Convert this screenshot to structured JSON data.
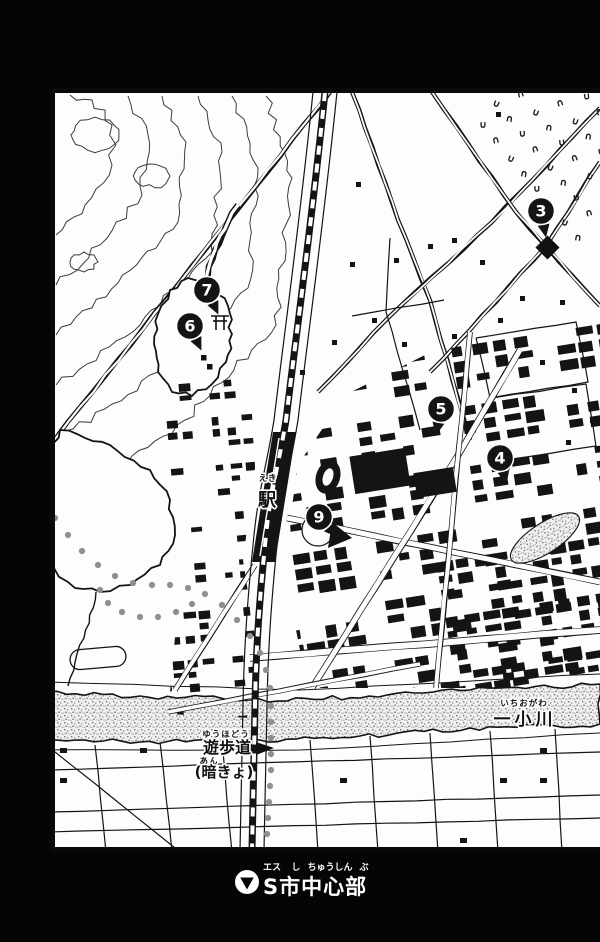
{
  "caption": {
    "ruby": [
      "エス",
      "し",
      "ちゅうしん",
      "ぶ"
    ],
    "text": "S市中心部",
    "bullet_icon": "triangle-down-in-circle"
  },
  "labels": {
    "station": {
      "ruby": "えき",
      "text": "駅"
    },
    "river": {
      "ruby": "いちおがわ",
      "text": "一小川"
    },
    "promenade": {
      "ruby": "ゆうほどう",
      "text": "遊歩道"
    },
    "culvert": {
      "ruby": "あん",
      "text": "(暗きょ)"
    }
  },
  "markers": [
    {
      "n": "3",
      "x": 541,
      "y": 211,
      "vx": 6,
      "vy": 32
    },
    {
      "n": "4",
      "x": 500,
      "y": 458,
      "vx": 6,
      "vy": 24
    },
    {
      "n": "5",
      "x": 441,
      "y": 409,
      "vx": -5,
      "vy": 26
    },
    {
      "n": "6",
      "x": 190,
      "y": 326,
      "vx": 14,
      "vy": 30
    },
    {
      "n": "7",
      "x": 207,
      "y": 290,
      "vx": 13,
      "vy": 28
    },
    {
      "n": "9",
      "x": 319,
      "y": 517,
      "vx": 19,
      "vy": 21
    }
  ],
  "colors": {
    "ink": "#141414",
    "paper": "#fdfdfd",
    "dots": "#8f8f8f",
    "stipple": "#b5b5b5"
  }
}
